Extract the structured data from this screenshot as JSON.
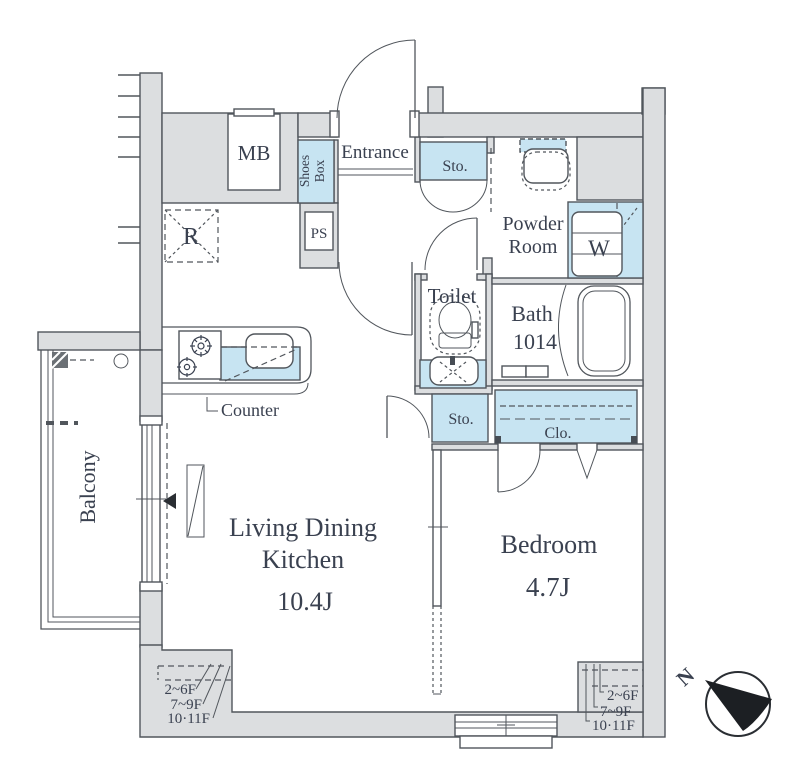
{
  "colors": {
    "wall_fill": "#dcdee0",
    "fixture_blue": "#c7e4f2",
    "line": "#51565c",
    "text": "#3a4150"
  },
  "rooms": {
    "ldk": {
      "name": "Living Dining",
      "name2": "Kitchen",
      "size": "10.4J"
    },
    "bedroom": {
      "name": "Bedroom",
      "size": "4.7J"
    },
    "balcony": {
      "name": "Balcony"
    },
    "entrance": {
      "name": "Entrance"
    },
    "powder": {
      "name": "Powder",
      "name2": "Room"
    },
    "toilet": {
      "name": "Toilet"
    },
    "bath": {
      "name": "Bath",
      "size": "1014"
    }
  },
  "fixtures": {
    "meter_box": "MB",
    "shoes_box_line1": "Shoes",
    "shoes_box_line2": "Box",
    "pipe_space": "PS",
    "refrigerator": "R",
    "storage_top": "Sto.",
    "storage_mid": "Sto.",
    "closet": "Clo.",
    "washer": "W",
    "counter": "Counter"
  },
  "annotations": {
    "floors_left": [
      "2~6F",
      "7~9F",
      "10·11F"
    ],
    "floors_right": [
      "2~6F",
      "7~9F",
      "10·11F"
    ],
    "compass_north": "N"
  }
}
